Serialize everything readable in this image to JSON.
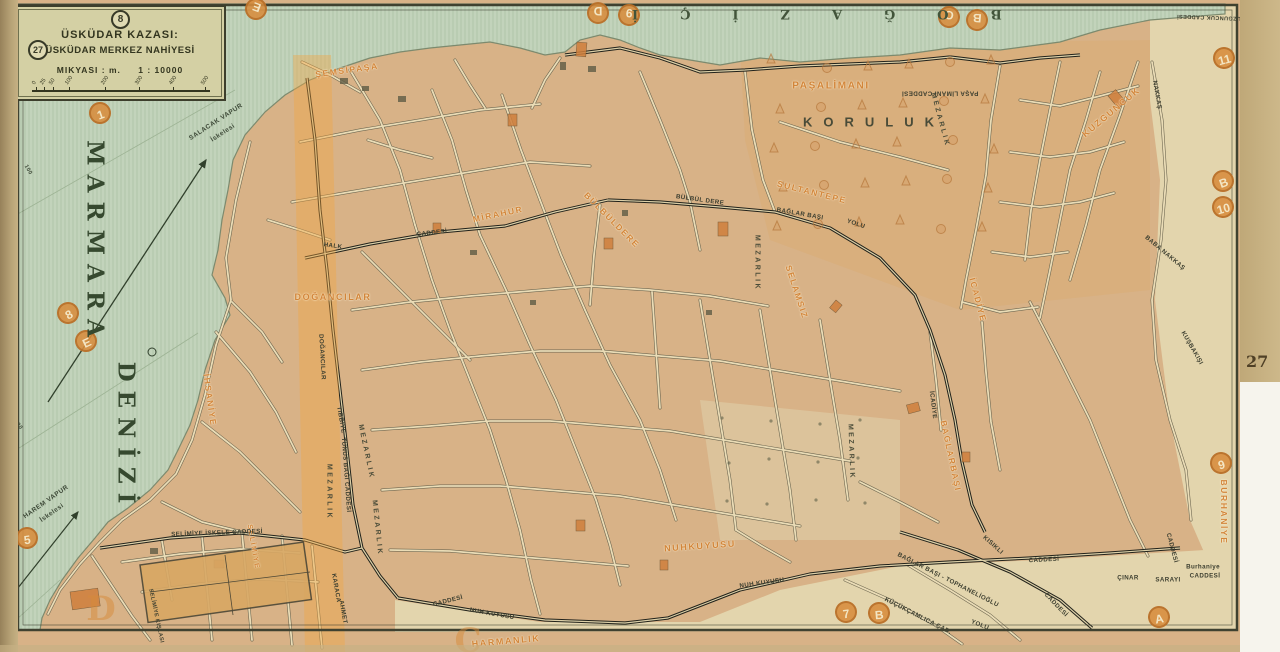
{
  "page_number": "27",
  "legend": {
    "sheet_circle": "8",
    "page_circle": "27",
    "title_line1": "ÜSKÜDAR KAZASI:",
    "title_line2": "ÜSKÜDAR MERKEZ NAHİYESİ",
    "scale_label": "MIKYASI : m.",
    "scale_ratio": "1 : 10000",
    "scale_ticks": [
      "0",
      "25",
      "50",
      "100",
      "200",
      "300",
      "400",
      "500"
    ]
  },
  "sea": {
    "name_word1": "MARMARA",
    "name_word2": "DENİZİ",
    "strait_name": "BOĞAZİÇİ"
  },
  "markers": [
    {
      "t": "E",
      "x": 256,
      "y": 9,
      "r": 200
    },
    {
      "t": "D",
      "x": 598,
      "y": 13,
      "r": 180
    },
    {
      "t": "9",
      "x": 629,
      "y": 15,
      "r": 185
    },
    {
      "t": "C",
      "x": 949,
      "y": 17,
      "r": 190
    },
    {
      "t": "B",
      "x": 977,
      "y": 20,
      "r": 185
    },
    {
      "t": "11",
      "x": 1224,
      "y": 58,
      "r": -15
    },
    {
      "t": "B",
      "x": 1223,
      "y": 181,
      "r": -20
    },
    {
      "t": "10",
      "x": 1223,
      "y": 207,
      "r": -15
    },
    {
      "t": "9",
      "x": 1221,
      "y": 463,
      "r": -15
    },
    {
      "t": "A",
      "x": 1159,
      "y": 617,
      "r": -10
    },
    {
      "t": "1",
      "x": 100,
      "y": 113,
      "r": -20
    },
    {
      "t": "8",
      "x": 68,
      "y": 313,
      "r": -30
    },
    {
      "t": "E",
      "x": 86,
      "y": 341,
      "r": -25
    },
    {
      "t": "5",
      "x": 27,
      "y": 538,
      "r": -8
    },
    {
      "t": "7",
      "x": 846,
      "y": 612,
      "r": -8
    },
    {
      "t": "B",
      "x": 879,
      "y": 613,
      "r": -5
    },
    {
      "t": "D",
      "x": 101,
      "y": 609,
      "r": 0,
      "wm": true
    },
    {
      "t": "C",
      "x": 468,
      "y": 641,
      "r": 0,
      "wm": true
    }
  ],
  "map_labels": [
    {
      "t": "ŞEMSİPAŞA",
      "x": 347,
      "y": 70,
      "r": -8,
      "k": "d"
    },
    {
      "t": "PAŞALİMANI",
      "x": 831,
      "y": 86,
      "r": 0,
      "k": "d",
      "s": 10
    },
    {
      "t": "KUZGUNCUK",
      "x": 1111,
      "y": 112,
      "r": -40,
      "k": "d",
      "s": 9
    },
    {
      "t": "SULTANTEPE",
      "x": 812,
      "y": 192,
      "r": 14,
      "k": "d"
    },
    {
      "t": "MİRAHUR",
      "x": 498,
      "y": 214,
      "r": -12,
      "k": "d"
    },
    {
      "t": "BÜLBÜLDERE",
      "x": 612,
      "y": 220,
      "r": 45,
      "k": "d"
    },
    {
      "t": "SELAMSIZ",
      "x": 797,
      "y": 292,
      "r": 72,
      "k": "d"
    },
    {
      "t": "İCADİYE",
      "x": 978,
      "y": 300,
      "r": 75,
      "k": "d"
    },
    {
      "t": "DOĞANCILAR",
      "x": 333,
      "y": 297,
      "r": 0,
      "k": "d",
      "s": 9
    },
    {
      "t": "İHSANİYE",
      "x": 210,
      "y": 400,
      "r": 82,
      "k": "d"
    },
    {
      "t": "BAĞLARBAŞI",
      "x": 951,
      "y": 456,
      "r": 78,
      "k": "d"
    },
    {
      "t": "BURHANİYE",
      "x": 1224,
      "y": 512,
      "r": 90,
      "k": "d"
    },
    {
      "t": "NUHKUYUSU",
      "x": 700,
      "y": 546,
      "r": -4,
      "k": "d",
      "s": 9
    },
    {
      "t": "HARMANLIK",
      "x": 506,
      "y": 641,
      "r": -5,
      "k": "d",
      "s": 9
    },
    {
      "t": "SELİMİYE",
      "x": 253,
      "y": 547,
      "r": 80,
      "k": "d",
      "s": 7
    },
    {
      "t": "KORULUK",
      "x": 874,
      "y": 122,
      "r": 0,
      "k": "a",
      "s": 13,
      "ls": 11
    },
    {
      "t": "MEZARLIK",
      "x": 757,
      "y": 263,
      "r": 90,
      "k": "a"
    },
    {
      "t": "MEZARLIK",
      "x": 940,
      "y": 120,
      "r": 75,
      "k": "a"
    },
    {
      "t": "MEZARLIK",
      "x": 851,
      "y": 452,
      "r": 88,
      "k": "a"
    },
    {
      "t": "MEZARLIK",
      "x": 329,
      "y": 492,
      "r": 90,
      "k": "a"
    },
    {
      "t": "MEZARLIK",
      "x": 366,
      "y": 452,
      "r": 78,
      "k": "a"
    },
    {
      "t": "MEZARLIK",
      "x": 377,
      "y": 528,
      "r": 84,
      "k": "a"
    },
    {
      "t": "PAŞA LİMANI CADDESİ",
      "x": 940,
      "y": 93,
      "r": 180,
      "k": "s"
    },
    {
      "t": "KUZGUNCUK CADDESİ",
      "x": 1211,
      "y": 17,
      "r": 182,
      "k": "s",
      "s": 5.5
    },
    {
      "t": "HALK",
      "x": 333,
      "y": 246,
      "r": 8,
      "k": "s"
    },
    {
      "t": "CADDESİ",
      "x": 432,
      "y": 233,
      "r": -6,
      "k": "s"
    },
    {
      "t": "BÜLBÜL DERE",
      "x": 700,
      "y": 200,
      "r": 8,
      "k": "s"
    },
    {
      "t": "BAĞLAR BAŞI",
      "x": 800,
      "y": 214,
      "r": 10,
      "k": "s"
    },
    {
      "t": "YOLU",
      "x": 856,
      "y": 224,
      "r": 18,
      "k": "s"
    },
    {
      "t": "TIBBİYE",
      "x": 341,
      "y": 420,
      "r": 80,
      "k": "s"
    },
    {
      "t": "TUNUS BAĞI CADDESİ",
      "x": 346,
      "y": 475,
      "r": 86,
      "k": "s"
    },
    {
      "t": "SELİMİYE İSKELE CADDESİ",
      "x": 217,
      "y": 533,
      "r": -2,
      "k": "s"
    },
    {
      "t": "CADDESİ",
      "x": 448,
      "y": 601,
      "r": -14,
      "k": "s"
    },
    {
      "t": "NUH KUYUSU",
      "x": 492,
      "y": 614,
      "r": 10,
      "k": "s"
    },
    {
      "t": "NUH KUYUSU",
      "x": 762,
      "y": 583,
      "r": -8,
      "k": "s"
    },
    {
      "t": "CADDESİ",
      "x": 1044,
      "y": 560,
      "r": -3,
      "k": "s"
    },
    {
      "t": "BAĞLAR BAŞI - TOPHANELİOĞLU",
      "x": 948,
      "y": 580,
      "r": 27,
      "k": "s"
    },
    {
      "t": "YOLU",
      "x": 980,
      "y": 625,
      "r": 22,
      "k": "s"
    },
    {
      "t": "KÜÇÜKÇAMLICA CAD.",
      "x": 918,
      "y": 616,
      "r": 27,
      "k": "s"
    },
    {
      "t": "KISIKLI",
      "x": 993,
      "y": 545,
      "r": 42,
      "k": "s"
    },
    {
      "t": "CADDESİ",
      "x": 1056,
      "y": 605,
      "r": 46,
      "k": "s"
    },
    {
      "t": "ÇINAR",
      "x": 1128,
      "y": 578,
      "r": 0,
      "k": "s"
    },
    {
      "t": "SARAYI",
      "x": 1168,
      "y": 580,
      "r": 0,
      "k": "s"
    },
    {
      "t": "Burhaniye",
      "x": 1203,
      "y": 567,
      "r": 0,
      "k": "s"
    },
    {
      "t": "CADDESİ",
      "x": 1205,
      "y": 576,
      "r": 0,
      "k": "s"
    },
    {
      "t": "CADDESİ",
      "x": 1172,
      "y": 548,
      "r": 75,
      "k": "s"
    },
    {
      "t": "KUŞBAKIŞI",
      "x": 1192,
      "y": 348,
      "r": 60,
      "k": "s"
    },
    {
      "t": "BABA NAKKAŞ",
      "x": 1165,
      "y": 253,
      "r": 40,
      "k": "s"
    },
    {
      "t": "NAKKAŞ",
      "x": 1157,
      "y": 95,
      "r": 80,
      "k": "s"
    },
    {
      "t": "İCADİYE",
      "x": 933,
      "y": 405,
      "r": 83,
      "k": "s"
    },
    {
      "t": "DOĞANCILAR",
      "x": 322,
      "y": 357,
      "r": 87,
      "k": "s"
    },
    {
      "t": "KARACA",
      "x": 336,
      "y": 588,
      "r": 80,
      "k": "s"
    },
    {
      "t": "AHMET",
      "x": 343,
      "y": 612,
      "r": 80,
      "k": "s"
    },
    {
      "t": "SELİMİYE KIŞLASI",
      "x": 156,
      "y": 616,
      "r": 78,
      "k": "s",
      "s": 5.5
    },
    {
      "t": "SALACAK VAPUR",
      "x": 216,
      "y": 122,
      "r": -33,
      "k": "w"
    },
    {
      "t": "İskelesi",
      "x": 223,
      "y": 133,
      "r": -33,
      "k": "w"
    },
    {
      "t": "HAREM VAPUR",
      "x": 46,
      "y": 502,
      "r": -35,
      "k": "w"
    },
    {
      "t": "İskelesi",
      "x": 52,
      "y": 513,
      "r": -35,
      "k": "w"
    },
    {
      "t": "100",
      "x": 28,
      "y": 170,
      "r": 60,
      "k": "w",
      "s": 5.5
    },
    {
      "t": "100",
      "x": 18,
      "y": 425,
      "r": 55,
      "k": "w",
      "s": 5.5
    }
  ]
}
